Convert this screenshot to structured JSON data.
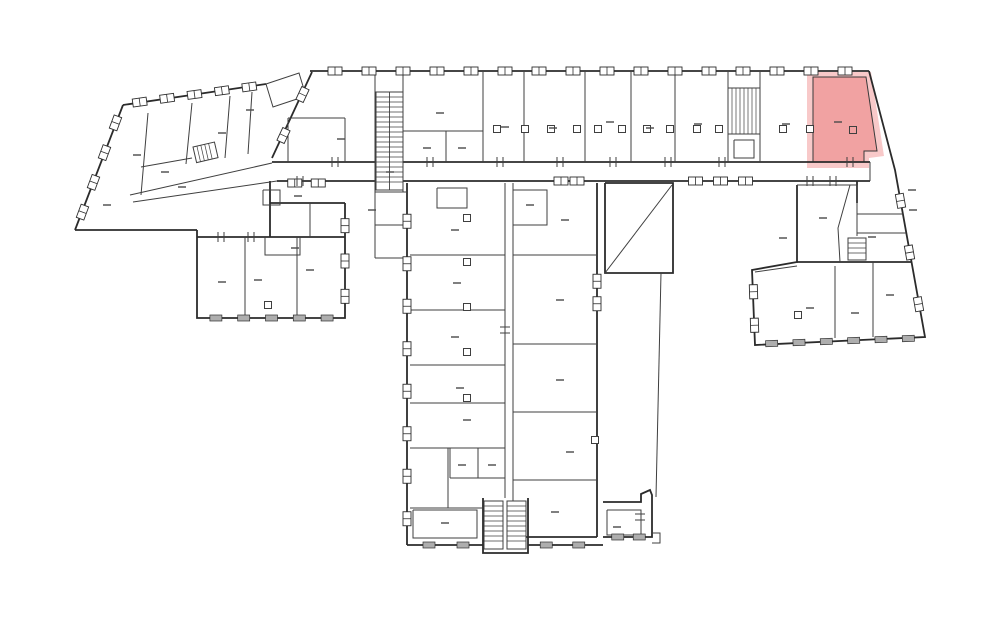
{
  "canvas": {
    "w": 1000,
    "h": 624,
    "bg": "#ffffff"
  },
  "colors": {
    "wall": "#2b2b2b",
    "thin": "#3f3f3f",
    "window_stroke": "#2e2e2e",
    "window_fill": "#ffffff",
    "window_gray": "#aeaeae",
    "label": "#4a4a4a",
    "highlight_fill": "#f1a2a2",
    "highlight_halo": "#f8c9c9",
    "highlight_outline": "#3a3a3a"
  },
  "highlighted_room": {
    "polygon": "813,77 866,77 877,151 864,151 864,162 813,162",
    "halo_polygon": "807,72 871,72 884,156 869,158 869,168 807,168",
    "label_dash": [
      838,
      122
    ],
    "door_square": [
      853,
      130
    ]
  },
  "walls_thick": [
    "310,71 869,71",
    "869,71 895,170 925,337 755,345 752,270 797,262 797,185",
    "312,72 272,158",
    "272,162 870,162",
    "277,181 870,181",
    "75,230 123,105",
    "123,105 266,84",
    "75,230 197,230",
    "197,230 197,318 345,318 345,203",
    "197,237 345,237",
    "270,203 345,203",
    "270,181 270,237",
    "407,183 407,545",
    "407,545 483,545",
    "528,545 603,545",
    "597,183 597,537",
    "605,183 673,183 673,273 605,273 605,183",
    "603,502 641,502 641,494 650,490 652,495 652,537 603,537",
    "857,181 857,203",
    "797,262 911,262",
    "483,498 483,553 528,553 528,498",
    "513,537 597,537"
  ],
  "walls_thin": [
    "375,72 375,162",
    "403,72 403,192",
    "483,72 483,162",
    "524,72 524,162",
    "585,72 585,162",
    "631,72 631,162",
    "675,72 675,162",
    "728,72 728,162",
    "760,72 760,162",
    "403,131 483,131",
    "446,131 446,162",
    "288,118 345,118",
    "345,118 345,162",
    "288,118 288,162",
    "266,84 299,73 306,96 273,107 266,84",
    "375,162 375,258",
    "375,192 407,192",
    "375,225 407,225",
    "375,258 407,258",
    "130,195 272,163",
    "133,202 277,181",
    "148,113 141,195",
    "192,103 186,164",
    "230,96 225,158",
    "252,92 248,154",
    "141,167 192,158",
    "263,190 280,190 280,205 263,205 263,190",
    "245,237 245,318",
    "297,237 297,318",
    "310,203 310,237",
    "265,237 265,255 300,255 300,237",
    "410,255 505,255",
    "410,310 505,310",
    "410,365 505,365",
    "410,403 505,403",
    "410,448 505,448",
    "450,448 450,478",
    "478,448 478,478",
    "450,478 505,478",
    "448,448 448,508",
    "410,508 483,508",
    "413,510 477,510 477,538 413,538 413,510",
    "437,188 467,188 467,208 437,208 437,188",
    "505,183 505,498",
    "513,183 513,545",
    "513,190 547,190 547,225 513,225",
    "513,255 597,255",
    "513,344 597,344",
    "513,412 597,412",
    "513,480 597,480",
    "605,273 672,185",
    "661,273 656,497",
    "797,185 857,185",
    "850,185 838,228 840,262",
    "857,185 857,236",
    "857,214 903,214",
    "857,233 906,233",
    "835,266 835,338",
    "873,262 873,337",
    "755,272 797,266",
    "870,162 870,181",
    "728,134 760,134",
    "734,140 754,140 754,158 734,158 734,140",
    "607,510 641,510 641,535 607,535 607,510",
    "652,533 660,533 660,543 652,543"
  ],
  "window_runs": [
    {
      "x1": 318,
      "y1": 71,
      "x2": 862,
      "y2": 71,
      "n": 16,
      "s": "box"
    },
    {
      "x1": 126,
      "y1": 104,
      "x2": 263,
      "y2": 85,
      "n": 5,
      "s": "box"
    },
    {
      "x1": 77,
      "y1": 227,
      "x2": 121,
      "y2": 108,
      "n": 4,
      "s": "box"
    },
    {
      "x1": 312,
      "y1": 74,
      "x2": 274,
      "y2": 156,
      "n": 2,
      "s": "box"
    },
    {
      "x1": 202,
      "y1": 318,
      "x2": 341,
      "y2": 318,
      "n": 5,
      "s": "gray"
    },
    {
      "x1": 345,
      "y1": 208,
      "x2": 345,
      "y2": 314,
      "n": 3,
      "s": "box"
    },
    {
      "x1": 407,
      "y1": 200,
      "x2": 407,
      "y2": 540,
      "n": 8,
      "s": "box"
    },
    {
      "x1": 412,
      "y1": 545,
      "x2": 480,
      "y2": 545,
      "n": 2,
      "s": "gray"
    },
    {
      "x1": 530,
      "y1": 545,
      "x2": 595,
      "y2": 545,
      "n": 2,
      "s": "gray"
    },
    {
      "x1": 607,
      "y1": 537,
      "x2": 650,
      "y2": 537,
      "n": 2,
      "s": "gray"
    },
    {
      "x1": 758,
      "y1": 344,
      "x2": 922,
      "y2": 338,
      "n": 6,
      "s": "gray"
    },
    {
      "x1": 896,
      "y1": 175,
      "x2": 923,
      "y2": 330,
      "n": 3,
      "s": "box"
    },
    {
      "x1": 753,
      "y1": 275,
      "x2": 755,
      "y2": 342,
      "n": 2,
      "s": "box"
    },
    {
      "x1": 597,
      "y1": 270,
      "x2": 597,
      "y2": 315,
      "n": 2,
      "s": "box"
    },
    {
      "x1": 683,
      "y1": 181,
      "x2": 758,
      "y2": 181,
      "n": 3,
      "s": "box"
    },
    {
      "x1": 553,
      "y1": 181,
      "x2": 585,
      "y2": 181,
      "n": 2,
      "s": "box"
    },
    {
      "x1": 283,
      "y1": 183,
      "x2": 330,
      "y2": 183,
      "n": 2,
      "s": "box"
    }
  ],
  "ticks": [
    {
      "x": 335,
      "y": 162,
      "a": 0
    },
    {
      "x": 430,
      "y": 162,
      "a": 0
    },
    {
      "x": 500,
      "y": 162,
      "a": 0
    },
    {
      "x": 560,
      "y": 162,
      "a": 0
    },
    {
      "x": 613,
      "y": 162,
      "a": 0
    },
    {
      "x": 668,
      "y": 162,
      "a": 0
    },
    {
      "x": 722,
      "y": 162,
      "a": 0
    },
    {
      "x": 850,
      "y": 162,
      "a": 0
    },
    {
      "x": 300,
      "y": 181,
      "a": 0
    },
    {
      "x": 810,
      "y": 181,
      "a": 0
    },
    {
      "x": 833,
      "y": 181,
      "a": 0
    },
    {
      "x": 221,
      "y": 237,
      "a": 0
    },
    {
      "x": 251,
      "y": 237,
      "a": 0
    },
    {
      "x": 640,
      "y": 517,
      "a": 90
    },
    {
      "x": 505,
      "y": 330,
      "a": 90
    }
  ],
  "door_squares": [
    [
      497,
      129
    ],
    [
      525,
      129
    ],
    [
      551,
      129
    ],
    [
      577,
      129
    ],
    [
      598,
      129
    ],
    [
      622,
      129
    ],
    [
      647,
      129
    ],
    [
      670,
      129
    ],
    [
      697,
      129
    ],
    [
      719,
      129
    ],
    [
      783,
      129
    ],
    [
      810,
      129
    ],
    [
      467,
      218
    ],
    [
      467,
      262
    ],
    [
      467,
      307
    ],
    [
      467,
      352
    ],
    [
      467,
      398
    ],
    [
      595,
      440
    ],
    [
      798,
      315
    ],
    [
      268,
      305
    ]
  ],
  "label_dashes": [
    [
      341,
      139
    ],
    [
      440,
      113
    ],
    [
      427,
      148
    ],
    [
      462,
      148
    ],
    [
      505,
      127
    ],
    [
      553,
      128
    ],
    [
      610,
      122
    ],
    [
      650,
      128
    ],
    [
      698,
      124
    ],
    [
      786,
      124
    ],
    [
      107,
      205
    ],
    [
      137,
      155
    ],
    [
      182,
      187
    ],
    [
      222,
      133
    ],
    [
      250,
      110
    ],
    [
      165,
      172
    ],
    [
      222,
      282
    ],
    [
      258,
      280
    ],
    [
      310,
      270
    ],
    [
      295,
      248
    ],
    [
      298,
      196
    ],
    [
      372,
      210
    ],
    [
      390,
      172
    ],
    [
      455,
      230
    ],
    [
      457,
      283
    ],
    [
      455,
      337
    ],
    [
      460,
      388
    ],
    [
      467,
      420
    ],
    [
      462,
      465
    ],
    [
      492,
      465
    ],
    [
      445,
      523
    ],
    [
      565,
      220
    ],
    [
      560,
      300
    ],
    [
      560,
      380
    ],
    [
      570,
      452
    ],
    [
      555,
      512
    ],
    [
      530,
      205
    ],
    [
      823,
      218
    ],
    [
      783,
      238
    ],
    [
      810,
      308
    ],
    [
      855,
      313
    ],
    [
      890,
      295
    ],
    [
      617,
      527
    ],
    [
      912,
      190
    ],
    [
      913,
      210
    ],
    [
      872,
      237
    ]
  ],
  "stairs": [
    {
      "x": 376,
      "y": 92,
      "w": 27,
      "h": 98,
      "dir": "h",
      "divider": true,
      "rot": 0
    },
    {
      "x": 728,
      "y": 88,
      "w": 32,
      "h": 46,
      "dir": "v",
      "divider": false,
      "rot": 0
    },
    {
      "x": 484,
      "y": 501,
      "w": 19,
      "h": 48,
      "dir": "h",
      "divider": false,
      "rot": 0
    },
    {
      "x": 507,
      "y": 501,
      "w": 19,
      "h": 48,
      "dir": "h",
      "divider": false,
      "rot": 0
    },
    {
      "x": 848,
      "y": 238,
      "w": 18,
      "h": 22,
      "dir": "h",
      "divider": false,
      "rot": 0
    },
    {
      "x": 193,
      "y": 147,
      "w": 22,
      "h": 16,
      "dir": "v",
      "divider": false,
      "rot": -13
    }
  ]
}
